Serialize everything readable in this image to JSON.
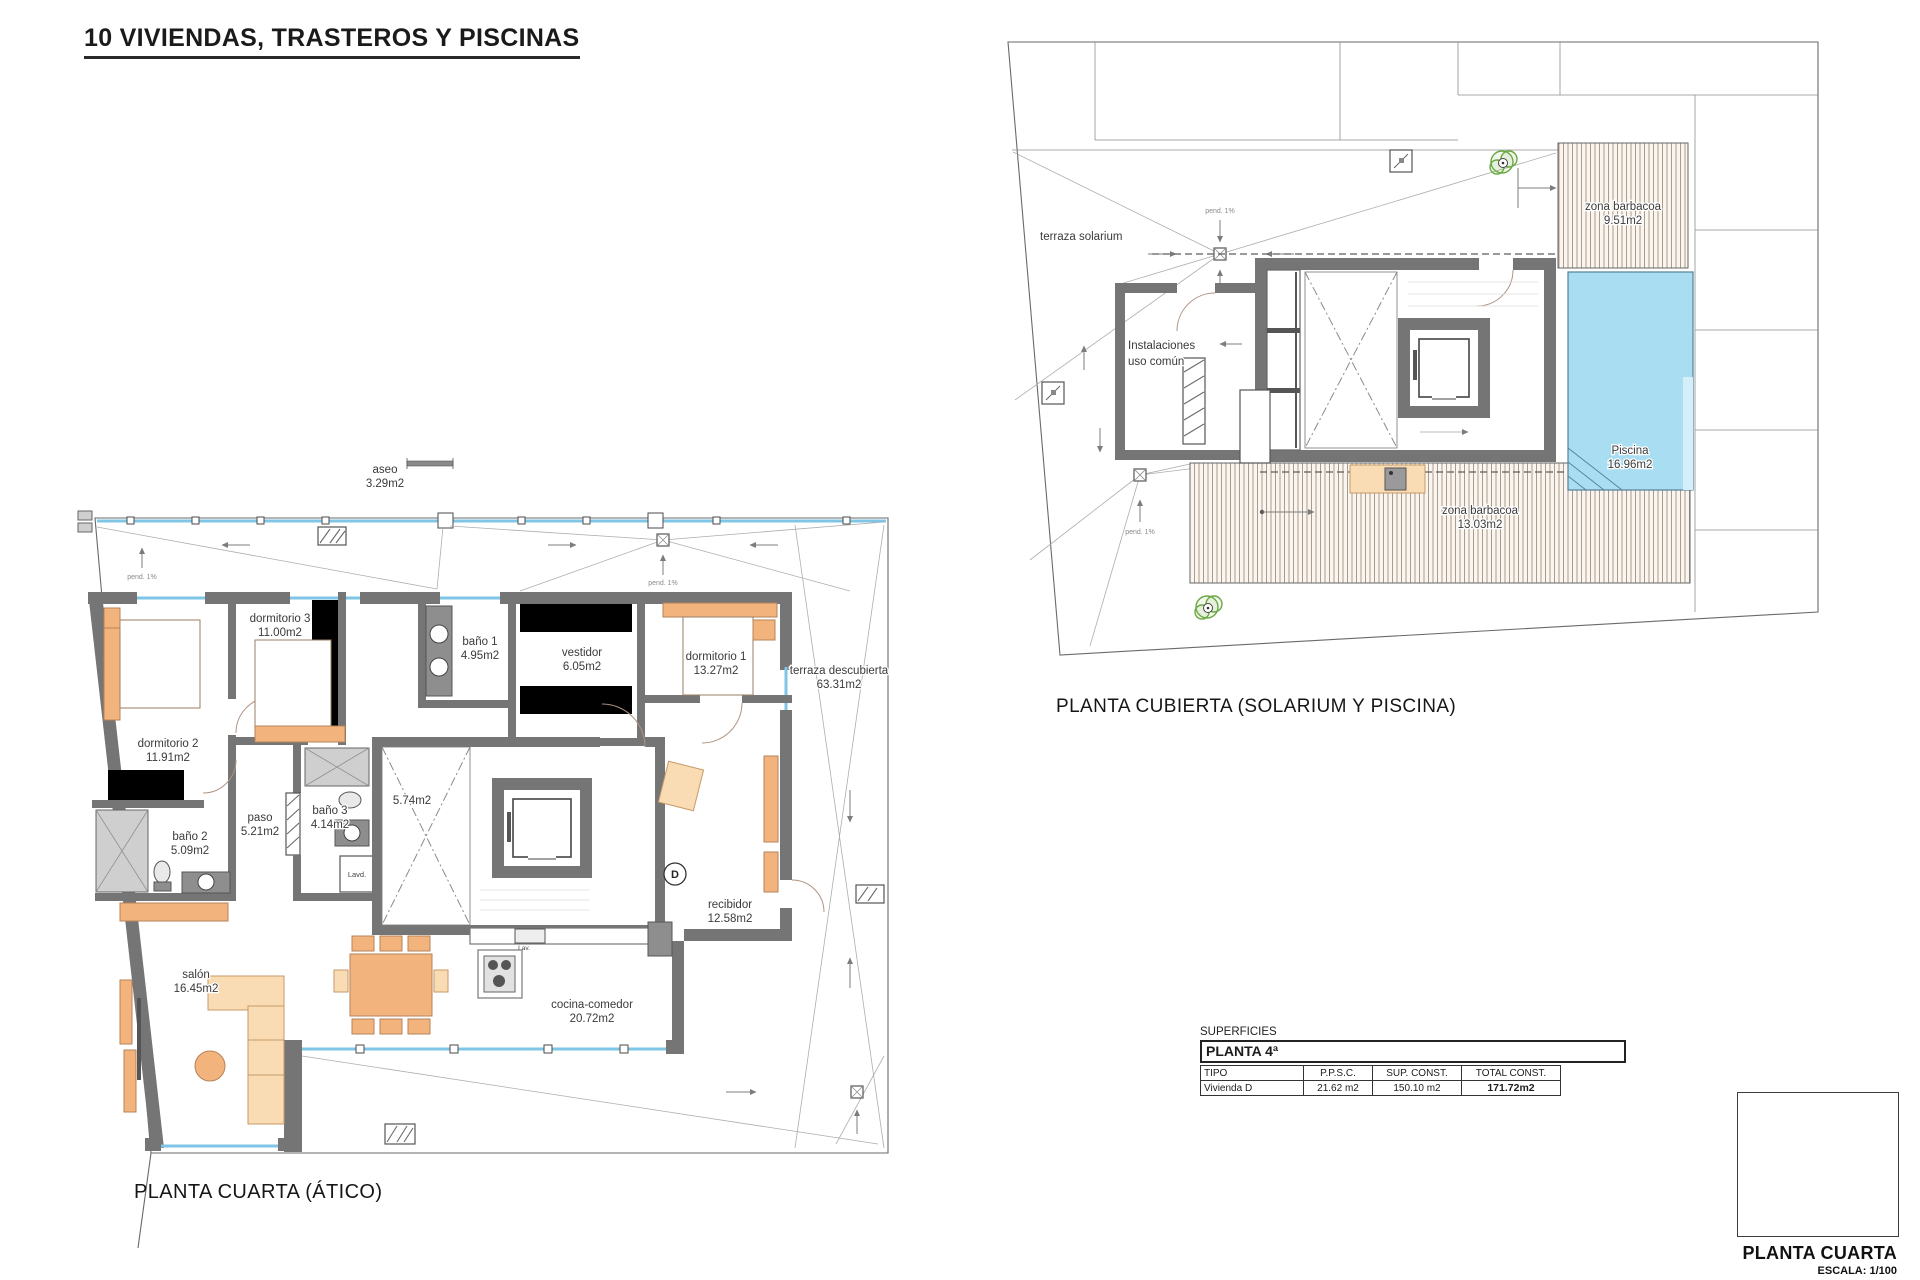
{
  "title": "10 VIVIENDAS, TRASTEROS Y PISCINAS",
  "colors": {
    "wall_gray": "#757575",
    "glazing_blue": "#7fc6e6",
    "pool_blue": "#a9def2",
    "furniture_orange": "#f2b37d",
    "deck_hatch": "#a09181",
    "shower_green": "#6aa844",
    "keyplan_hatch": "#dfa0a0"
  },
  "plan_atico": {
    "caption": "PLANTA CUARTA (ÁTICO)",
    "labels": {
      "aseo": {
        "l1": "aseo",
        "l2": "3.29m2"
      },
      "dorm3": {
        "l1": "dormitorio 3",
        "l2": "11.00m2"
      },
      "bano1": {
        "l1": "baño 1",
        "l2": "4.95m2"
      },
      "vestidor": {
        "l1": "vestidor",
        "l2": "6.05m2"
      },
      "dorm1": {
        "l1": "dormitorio 1",
        "l2": "13.27m2"
      },
      "terraza": {
        "l1": "terraza descubierta",
        "l2": "63.31m2"
      },
      "dorm2": {
        "l1": "dormitorio 2",
        "l2": "11.91m2"
      },
      "paso": {
        "l1": "paso",
        "l2": "5.21m2"
      },
      "bano3": {
        "l1": "baño 3",
        "l2": "4.14m2"
      },
      "distribuidor": {
        "l1": "5.74m2",
        "l2": ""
      },
      "bano2": {
        "l1": "baño 2",
        "l2": "5.09m2"
      },
      "lavadero": {
        "l1": "Lavd.",
        "l2": ""
      },
      "lavavajillas": {
        "l1": "Lav.",
        "l2": ""
      },
      "recibidor": {
        "l1": "recibidor",
        "l2": "12.58m2"
      },
      "salon": {
        "l1": "salón",
        "l2": "16.45m2"
      },
      "cocina": {
        "l1": "cocina-comedor",
        "l2": "20.72m2"
      },
      "marker": "D",
      "pend": "pend. 1%"
    }
  },
  "plan_cubierta": {
    "caption": "PLANTA CUBIERTA (SOLARIUM Y PISCINA)",
    "labels": {
      "solarium": {
        "l1": "terraza solarium",
        "l2": ""
      },
      "instalaciones": {
        "l1": "Instalaciones",
        "l2": "uso común"
      },
      "barbacoa1": {
        "l1": "zona barbacoa",
        "l2": "9.51m2"
      },
      "piscina": {
        "l1": "Piscina",
        "l2": "16.96m2"
      },
      "barbacoa2": {
        "l1": "zona barbacoa",
        "l2": "13.03m2"
      },
      "pend": "pend. 1%"
    }
  },
  "surfaces_table": {
    "section_label": "SUPERFICIES",
    "floor_title": "PLANTA 4ª",
    "headers": [
      "TIPO",
      "P.P.S.C.",
      "SUP. CONST.",
      "TOTAL CONST."
    ],
    "rows": [
      {
        "tipo": "Vivienda D",
        "ppsc": "21.62 m2",
        "sup": "150.10 m2",
        "total": "171.72m2"
      }
    ]
  },
  "keyplan": {
    "marker": "D",
    "caption": "PLANTA CUARTA",
    "scale": "ESCALA: 1/100"
  }
}
